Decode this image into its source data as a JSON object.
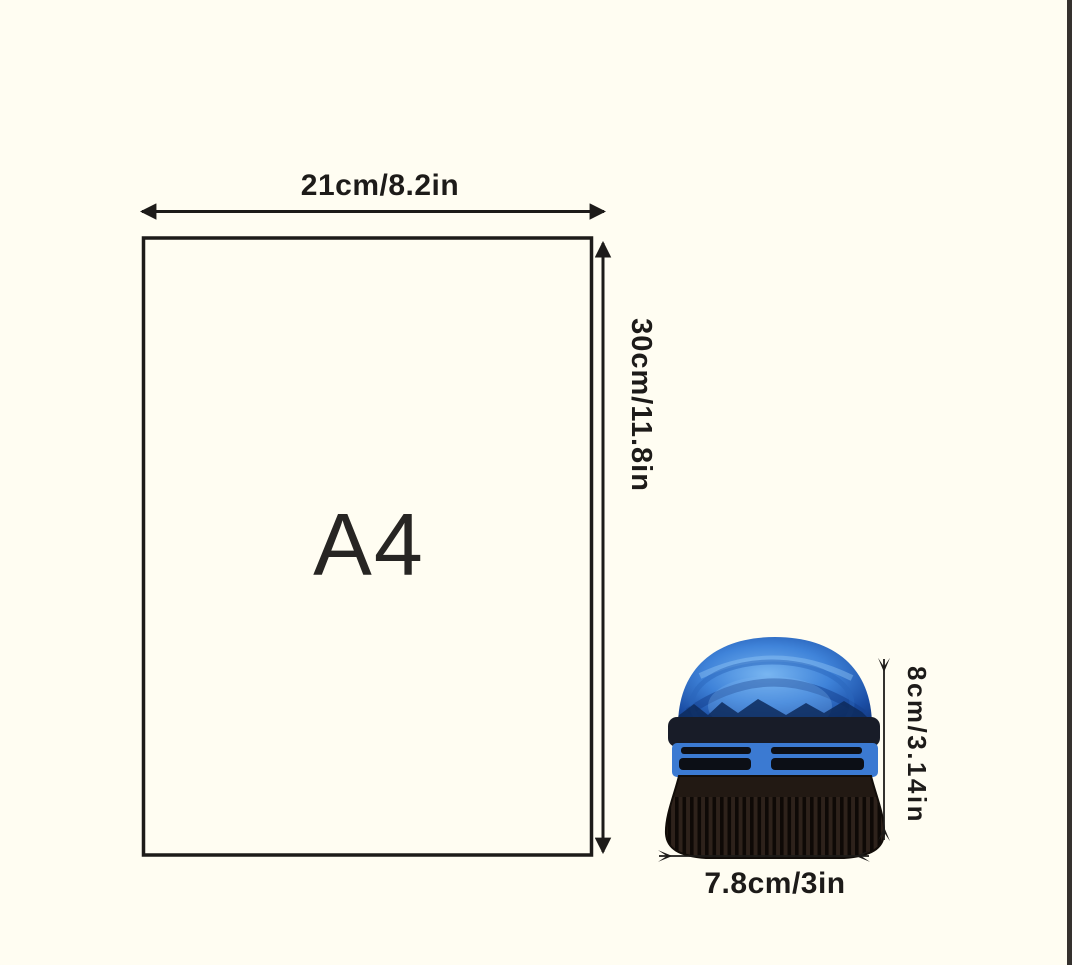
{
  "page": {
    "background": "#fffdf2",
    "right_edge_strip": "#35312e",
    "ink": "#1d1b19"
  },
  "a4_box": {
    "label": "A4",
    "width_label": "21cm/8.2in",
    "height_label": "30cm/11.8in"
  },
  "product": {
    "name": "mini dome galaxy projector",
    "width_label": "7.8cm/3in",
    "height_label": "8cm/3.14in",
    "colors": {
      "dome_center": "#79b6f1",
      "dome_mid": "#3f83d9",
      "dome_edge": "#1b4ea5",
      "dome_rim": "#143c86",
      "mountains": "#0d2a5c",
      "band": "#181c28",
      "vent": "#3b7ad2",
      "slot": "#0c0f16",
      "base": "#221913",
      "rib_ridge": "#2e221b",
      "rib_groove": "#0e0906",
      "highlight": "#a8d2f6"
    }
  }
}
